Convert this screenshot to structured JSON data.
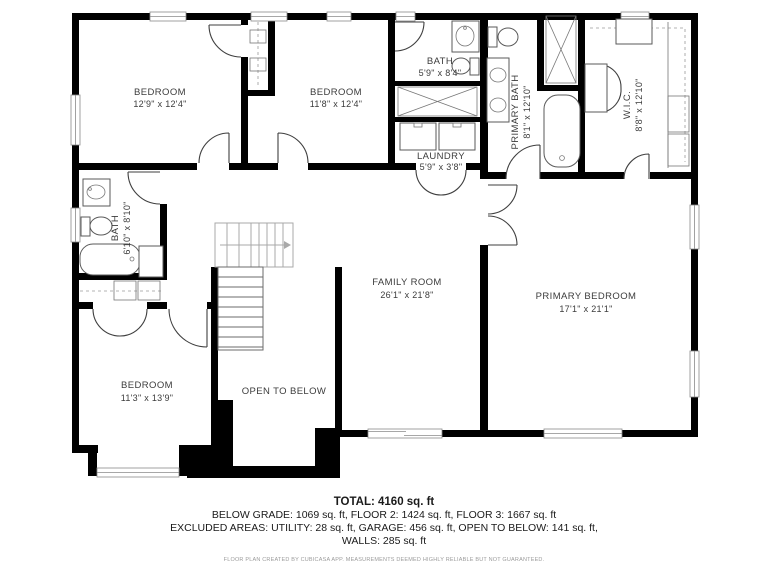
{
  "plan": {
    "rooms": {
      "bedroom_top_left": {
        "name": "BEDROOM",
        "dims": "12'9\" x 12'4\""
      },
      "bedroom_top_middle": {
        "name": "BEDROOM",
        "dims": "11'8\" x 12'4\""
      },
      "bath_upper": {
        "name": "BATH",
        "dims": "5'9\" x 8'4\""
      },
      "laundry": {
        "name": "LAUNDRY",
        "dims": "5'9\" x 3'8\""
      },
      "primary_bath": {
        "name": "PRIMARY BATH",
        "dims": "8'1\" x 12'10\""
      },
      "wic": {
        "name": "W.I.C.",
        "dims": "8'8\" x 12'10\""
      },
      "bath_left": {
        "name": "BATH",
        "dims": "6'10\" x 8'10\""
      },
      "family_room": {
        "name": "FAMILY ROOM",
        "dims": "26'1\" x 21'8\""
      },
      "primary_bedroom": {
        "name": "PRIMARY BEDROOM",
        "dims": "17'1\" x 21'1\""
      },
      "bedroom_bottom_left": {
        "name": "BEDROOM",
        "dims": "11'3\" x 13'9\""
      },
      "open_to_below": {
        "name": "OPEN TO BELOW"
      }
    }
  },
  "summary": {
    "total": "TOTAL: 4160 sq. ft",
    "line2": "BELOW GRADE: 1069 sq. ft, FLOOR 2: 1424 sq. ft, FLOOR 3: 1667 sq. ft",
    "line3": "EXCLUDED AREAS: UTILITY: 28 sq. ft, GARAGE: 456 sq. ft, OPEN TO BELOW: 141 sq. ft,",
    "line4": "WALLS: 285 sq. ft"
  },
  "footer": {
    "disclaimer": "FLOOR PLAN CREATED BY CUBICASA APP. MEASUREMENTS DEEMED HIGHLY RELIABLE BUT NOT GUARANTEED."
  },
  "colors": {
    "wall": "#000000",
    "label": "#3c3c3c",
    "stair_above_cut": "#a9a9a9"
  }
}
